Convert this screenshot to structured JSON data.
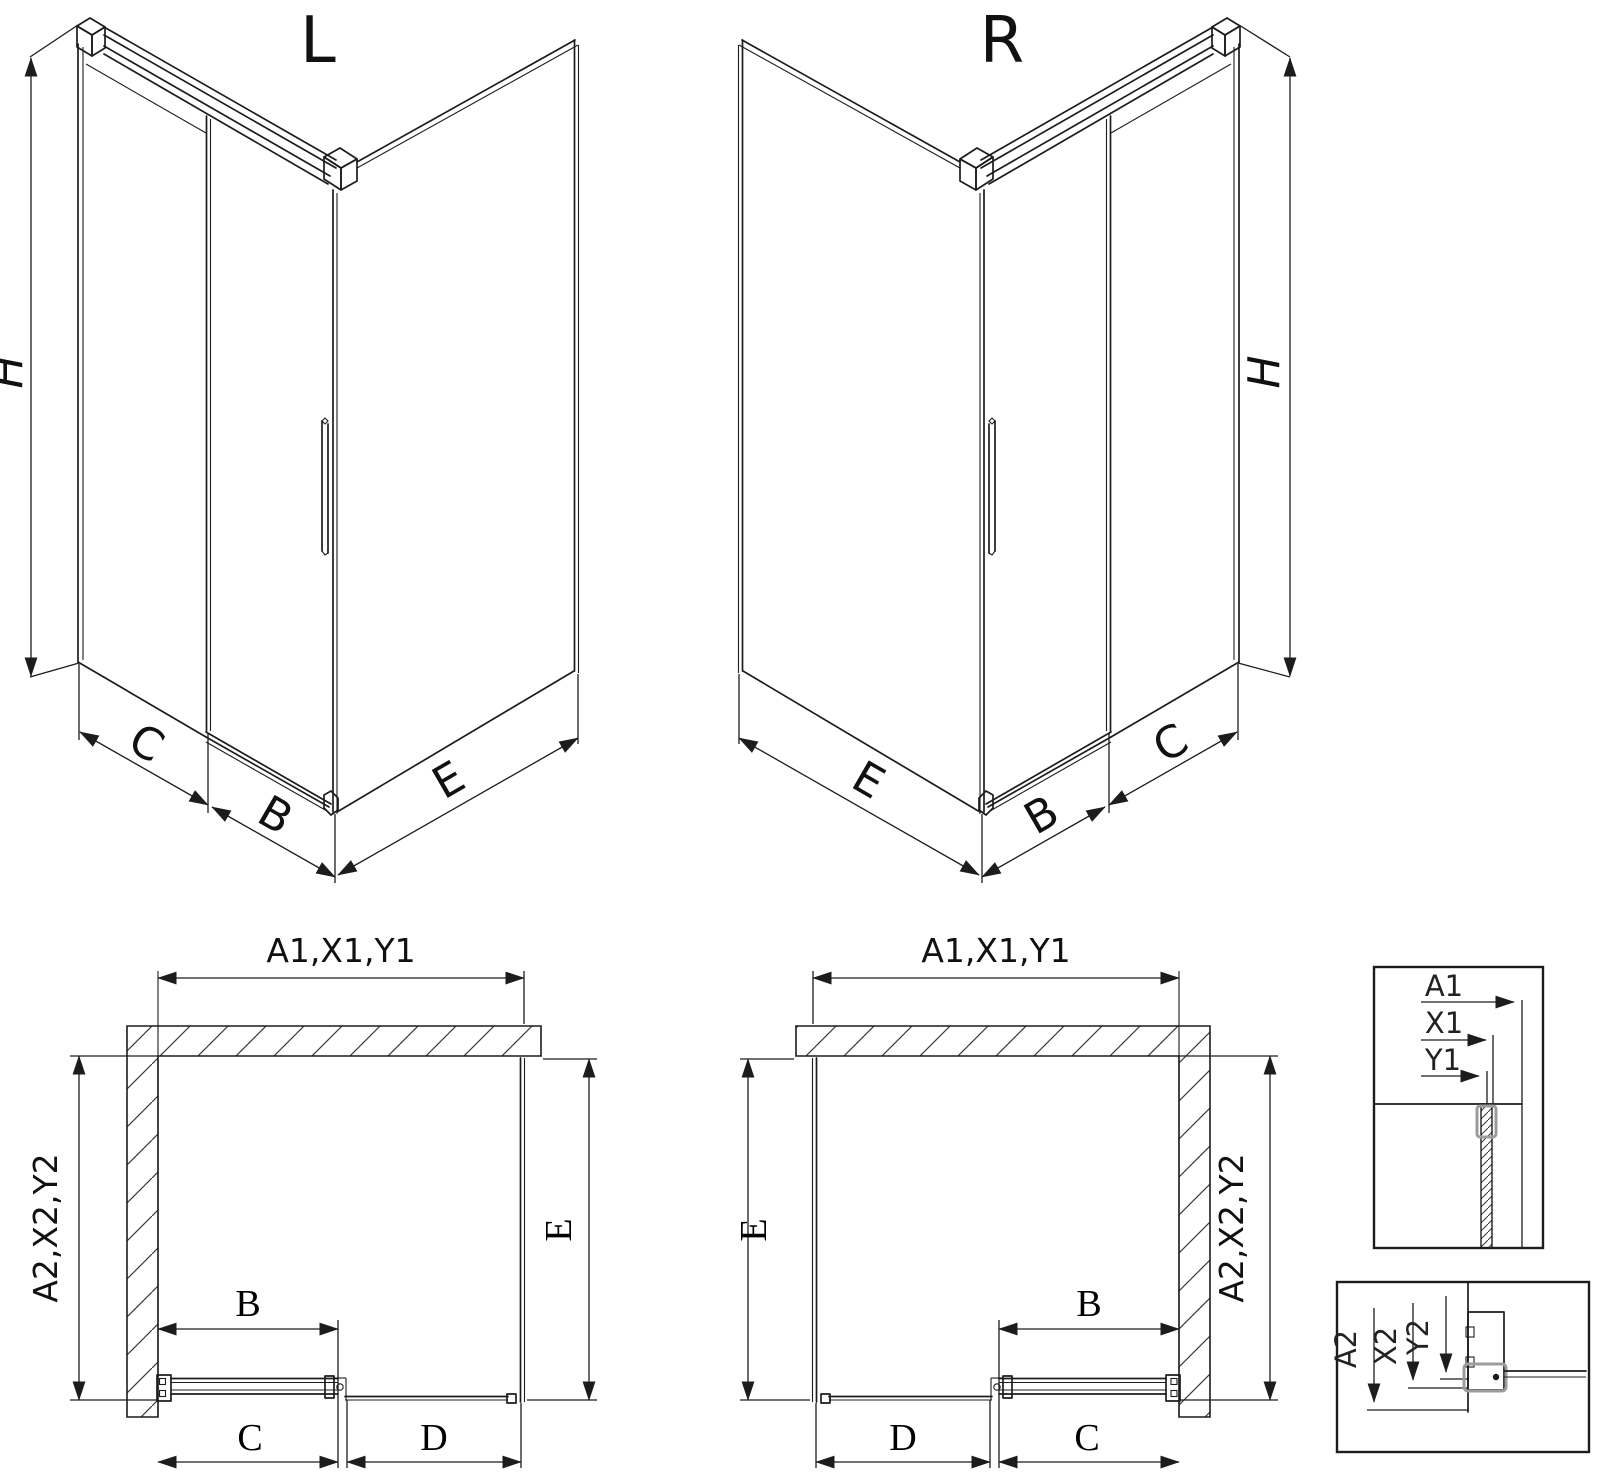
{
  "drawing": {
    "iso_left": {
      "title": "L",
      "dim_height": "H",
      "dim_fixed": "C",
      "dim_door": "B",
      "dim_side": "E"
    },
    "iso_right": {
      "title": "R",
      "dim_height": "H",
      "dim_fixed": "C",
      "dim_door": "B",
      "dim_side": "E"
    },
    "plan_left": {
      "dim_width": "A1,X1,Y1",
      "dim_depth": "A2,X2,Y2",
      "dim_side": "E",
      "dim_door": "B",
      "dim_fixed": "C",
      "dim_opening": "D"
    },
    "plan_right": {
      "dim_width": "A1,X1,Y1",
      "dim_depth": "A2,X2,Y2",
      "dim_side": "E",
      "dim_door": "B",
      "dim_fixed": "C",
      "dim_opening": "D"
    },
    "detail_horizontal": {
      "dim_outer": "A1",
      "dim_mid": "X1",
      "dim_inner": "Y1"
    },
    "detail_vertical": {
      "dim_outer": "A2",
      "dim_mid": "X2",
      "dim_inner": "Y2"
    },
    "colors": {
      "line": "#1c1c1c",
      "profile_gray": "#9c9c9c",
      "background": "#ffffff"
    }
  }
}
